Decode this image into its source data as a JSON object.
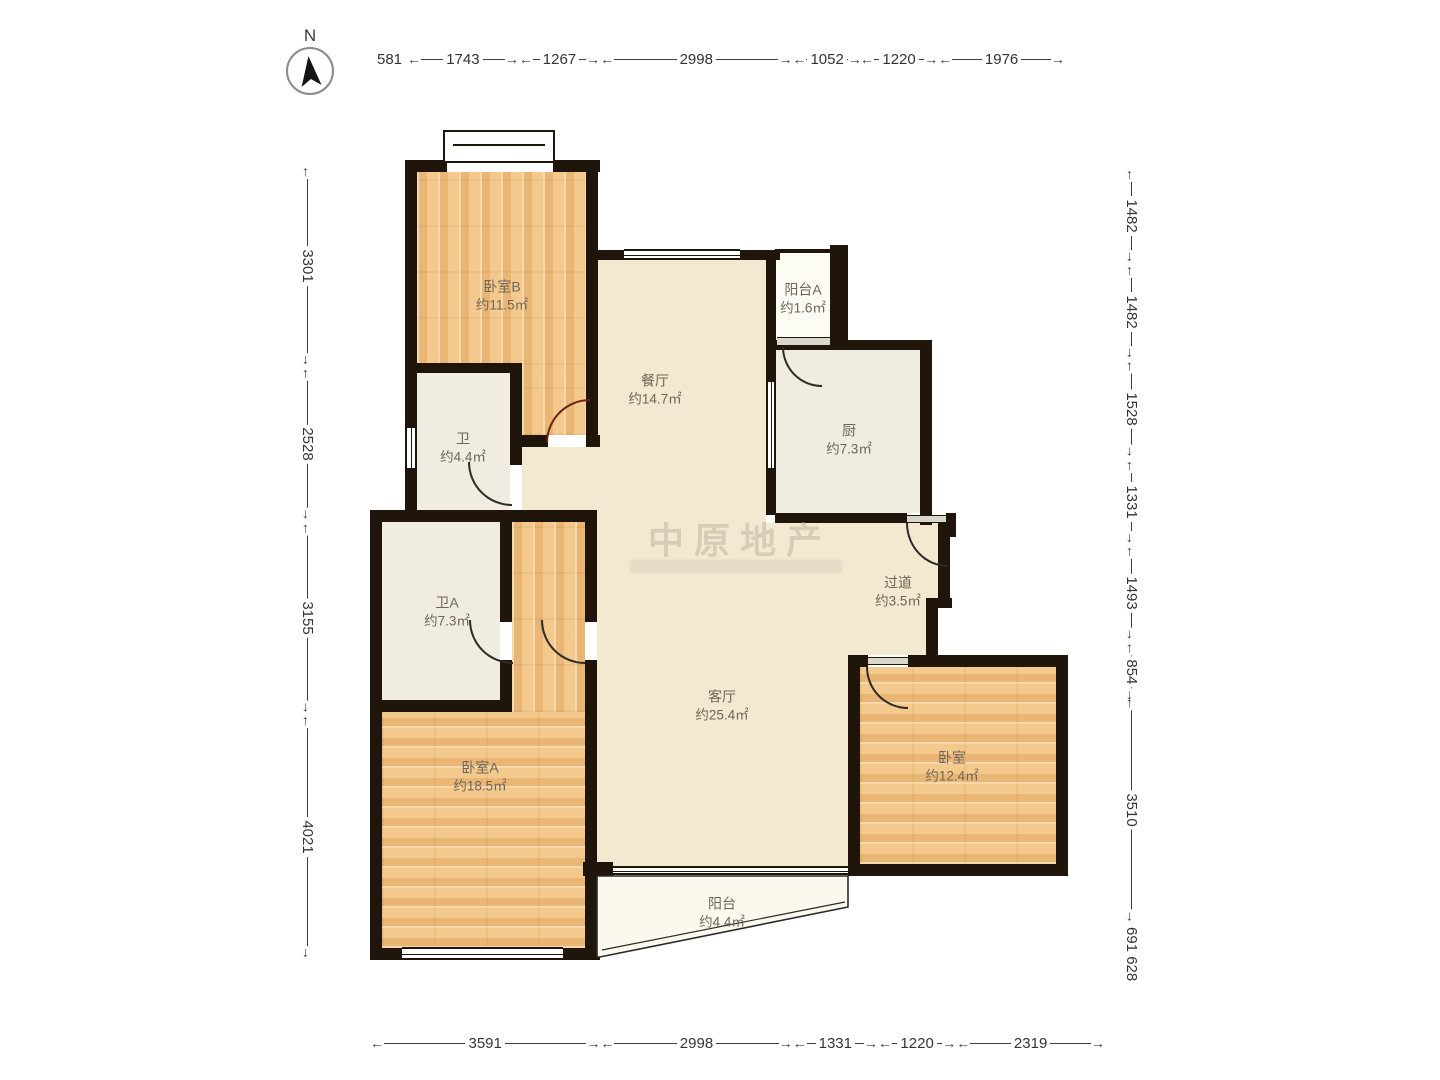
{
  "compass": {
    "label": "N"
  },
  "watermark": {
    "text": "中原地产"
  },
  "rulers": {
    "top": {
      "prefix": "581",
      "values": [
        "1743",
        "1267",
        "2998",
        "1052",
        "1220",
        "1976"
      ]
    },
    "bottom": {
      "values": [
        "3591",
        "2998",
        "1331",
        "1220",
        "2319"
      ]
    },
    "left": {
      "values": [
        "3301",
        "2528",
        "3155",
        "4021"
      ]
    },
    "right": {
      "values": [
        "1482",
        "1482",
        "1528",
        "1331",
        "1493",
        "854",
        "3510"
      ],
      "suffix": "691 628"
    }
  },
  "rooms": {
    "bedroom_b": {
      "name": "卧室B",
      "area": "约11.5㎡"
    },
    "dining": {
      "name": "餐厅",
      "area": "约14.7㎡"
    },
    "balcony_a": {
      "name": "阳台A",
      "area": "约1.6㎡"
    },
    "kitchen": {
      "name": "厨",
      "area": "约7.3㎡"
    },
    "bath": {
      "name": "卫",
      "area": "约4.4㎡"
    },
    "bath_a": {
      "name": "卫A",
      "area": "约7.3㎡"
    },
    "hallway": {
      "name": "过道",
      "area": "约3.5㎡"
    },
    "living": {
      "name": "客厅",
      "area": "约25.4㎡"
    },
    "bedroom_a": {
      "name": "卧室A",
      "area": "约18.5㎡"
    },
    "bedroom": {
      "name": "卧室",
      "area": "约12.4㎡"
    },
    "balcony": {
      "name": "阳台",
      "area": "约4.4㎡"
    }
  },
  "colors": {
    "wall": "#20150b",
    "wood": "#f1c183",
    "beige": "#f3e8d0",
    "service": "#f0ece1",
    "door": "#2e2b26",
    "door_accent": "#6e2012",
    "dimension_text": "#333333"
  }
}
